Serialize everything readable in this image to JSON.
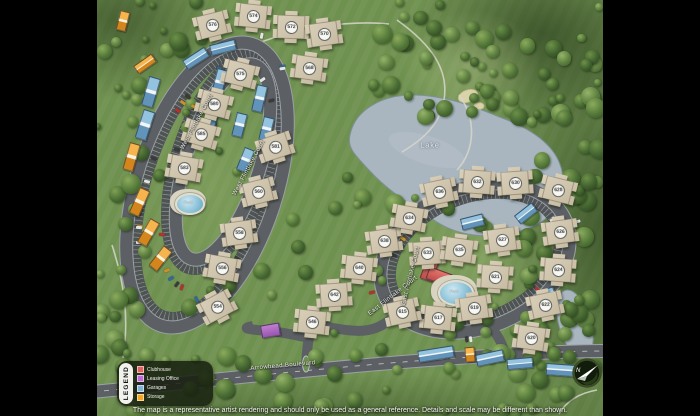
{
  "labels": {
    "lake": "Lake",
    "disclaimer": "The map is a representative artist rendering and should only be used as a general reference. Details and scale may be different than shown.",
    "compass_n": "N"
  },
  "streets": [
    {
      "id": "west-flintlake-court-outer",
      "text": "West Flintlake Court",
      "x": 100,
      "y": 122,
      "rot": -62
    },
    {
      "id": "west-flintlake-court-inner",
      "text": "West Flintlake Court",
      "x": 152,
      "y": 168,
      "rot": -62
    },
    {
      "id": "east-flintlake-court-west",
      "text": "East Flintlake Court",
      "x": 314,
      "y": 276,
      "rot": -76
    },
    {
      "id": "east-flintlake-court-south",
      "text": "East Flintlake Court",
      "x": 296,
      "y": 296,
      "rot": -38
    },
    {
      "id": "arrowhead-boulevard",
      "text": "Arrowhead Boulevard",
      "x": 186,
      "y": 366,
      "rot": -5
    }
  ],
  "pool_labels": [
    {
      "text": "Pool",
      "x": 91,
      "y": 202
    },
    {
      "text": "Pool",
      "x": 357,
      "y": 291
    }
  ],
  "legend": {
    "title": "LEGEND",
    "items": [
      {
        "label": "Clubhouse",
        "color": "#e0645f"
      },
      {
        "label": "Leasing Office",
        "color": "#bc6fd0"
      },
      {
        "label": "Garages",
        "color": "#7fb3d8"
      },
      {
        "label": "Storage",
        "color": "#f5a623"
      }
    ]
  },
  "buildings": [
    {
      "num": "576",
      "x": 115,
      "y": 25,
      "rot": -14
    },
    {
      "num": "574",
      "x": 156,
      "y": 16,
      "rot": 6
    },
    {
      "num": "572",
      "x": 194,
      "y": 27,
      "rot": 2
    },
    {
      "num": "570",
      "x": 227,
      "y": 34,
      "rot": -8
    },
    {
      "num": "568",
      "x": 212,
      "y": 68,
      "rot": 8
    },
    {
      "num": "575",
      "x": 143,
      "y": 74,
      "rot": 14
    },
    {
      "num": "580",
      "x": 117,
      "y": 104,
      "rot": 14
    },
    {
      "num": "585",
      "x": 104,
      "y": 134,
      "rot": 16
    },
    {
      "num": "583",
      "x": 87,
      "y": 168,
      "rot": 10
    },
    {
      "num": "581",
      "x": 178,
      "y": 147,
      "rot": -18
    },
    {
      "num": "560",
      "x": 161,
      "y": 192,
      "rot": -14
    },
    {
      "num": "558",
      "x": 142,
      "y": 233,
      "rot": -8
    },
    {
      "num": "556",
      "x": 125,
      "y": 268,
      "rot": 10
    },
    {
      "num": "554",
      "x": 120,
      "y": 307,
      "rot": -28
    },
    {
      "num": "546",
      "x": 215,
      "y": 322,
      "rot": 6
    },
    {
      "num": "638",
      "x": 287,
      "y": 241,
      "rot": -8
    },
    {
      "num": "640",
      "x": 262,
      "y": 268,
      "rot": 6
    },
    {
      "num": "642",
      "x": 237,
      "y": 295,
      "rot": -4
    },
    {
      "num": "636",
      "x": 342,
      "y": 192,
      "rot": -12
    },
    {
      "num": "634",
      "x": 312,
      "y": 218,
      "rot": 10
    },
    {
      "num": "632",
      "x": 380,
      "y": 182,
      "rot": 4
    },
    {
      "num": "630",
      "x": 418,
      "y": 183,
      "rot": -4
    },
    {
      "num": "628",
      "x": 461,
      "y": 190,
      "rot": 14
    },
    {
      "num": "626",
      "x": 463,
      "y": 232,
      "rot": -8
    },
    {
      "num": "624",
      "x": 461,
      "y": 270,
      "rot": 4
    },
    {
      "num": "622",
      "x": 448,
      "y": 305,
      "rot": -12
    },
    {
      "num": "620",
      "x": 434,
      "y": 338,
      "rot": 8
    },
    {
      "num": "633",
      "x": 330,
      "y": 253,
      "rot": -4
    },
    {
      "num": "635",
      "x": 362,
      "y": 250,
      "rot": 8
    },
    {
      "num": "627",
      "x": 405,
      "y": 240,
      "rot": -8
    },
    {
      "num": "621",
      "x": 398,
      "y": 277,
      "rot": 4
    },
    {
      "num": "619",
      "x": 377,
      "y": 308,
      "rot": -8
    },
    {
      "num": "617",
      "x": 341,
      "y": 318,
      "rot": 6
    },
    {
      "num": "615",
      "x": 305,
      "y": 312,
      "rot": -12
    }
  ],
  "garages": [
    {
      "x": 98,
      "y": 57,
      "w": 24,
      "h": 9,
      "rot": -33
    },
    {
      "x": 125,
      "y": 46,
      "w": 24,
      "h": 9,
      "rot": -14
    },
    {
      "x": 53,
      "y": 91,
      "w": 10,
      "h": 28,
      "rot": 16
    },
    {
      "x": 47,
      "y": 124,
      "w": 10,
      "h": 28,
      "rot": 18
    },
    {
      "x": 121,
      "y": 81,
      "w": 9,
      "h": 25,
      "rot": 15
    },
    {
      "x": 114,
      "y": 114,
      "w": 9,
      "h": 25,
      "rot": 15
    },
    {
      "x": 161,
      "y": 97,
      "w": 9,
      "h": 25,
      "rot": 13
    },
    {
      "x": 168,
      "y": 128,
      "w": 9,
      "h": 22,
      "rot": 14
    },
    {
      "x": 141,
      "y": 124,
      "w": 9,
      "h": 22,
      "rot": 14
    },
    {
      "x": 147,
      "y": 159,
      "w": 9,
      "h": 22,
      "rot": 22
    },
    {
      "x": 374,
      "y": 221,
      "w": 21,
      "h": 10,
      "rot": -14
    },
    {
      "x": 428,
      "y": 212,
      "w": 20,
      "h": 9,
      "rot": -38
    },
    {
      "x": 447,
      "y": 293,
      "w": 17,
      "h": 8,
      "rot": -18
    },
    {
      "x": 338,
      "y": 353,
      "w": 34,
      "h": 10,
      "rot": -9
    },
    {
      "x": 392,
      "y": 357,
      "w": 26,
      "h": 10,
      "rot": -12
    },
    {
      "x": 422,
      "y": 362,
      "w": 24,
      "h": 9,
      "rot": -5
    },
    {
      "x": 463,
      "y": 369,
      "w": 28,
      "h": 10,
      "rot": 4
    }
  ],
  "storage": [
    {
      "x": 33,
      "y": 156,
      "w": 9,
      "h": 26,
      "rot": 16
    },
    {
      "x": 41,
      "y": 201,
      "w": 9,
      "h": 26,
      "rot": 24
    },
    {
      "x": 50,
      "y": 231,
      "w": 9,
      "h": 25,
      "rot": 30
    },
    {
      "x": 62,
      "y": 257,
      "w": 9,
      "h": 23,
      "rot": 38
    },
    {
      "x": 47,
      "y": 63,
      "w": 20,
      "h": 8,
      "rot": -35
    },
    {
      "x": 25,
      "y": 20,
      "w": 8,
      "h": 18,
      "rot": 14
    },
    {
      "x": 372,
      "y": 353,
      "w": 8,
      "h": 13,
      "rot": -5
    }
  ],
  "clubhouse": [
    {
      "x": 332,
      "y": 266,
      "w": 11,
      "h": 26,
      "rot": 20
    },
    {
      "x": 341,
      "y": 275,
      "w": 22,
      "h": 11,
      "rot": 20
    }
  ],
  "leasing_office": [
    {
      "x": 172,
      "y": 329,
      "w": 17,
      "h": 11,
      "rot": -10
    }
  ],
  "pools": [
    {
      "x": 91,
      "y": 202,
      "rx": 13,
      "ry": 9,
      "drx": 18,
      "dry": 13
    },
    {
      "x": 357,
      "y": 291,
      "rx": 16,
      "ry": 11,
      "drx": 23,
      "dry": 16
    }
  ],
  "colors": {
    "grass": "#6f9150",
    "forest": "#41602e",
    "road": "#5c6064",
    "parking": "#4c5054",
    "water": "#a9b6c0",
    "building": "#cec3ac",
    "clubhouse": "#e0645f",
    "leasing": "#bc6fd0",
    "garage": "#7fb3d8",
    "storage": "#f5a623"
  }
}
